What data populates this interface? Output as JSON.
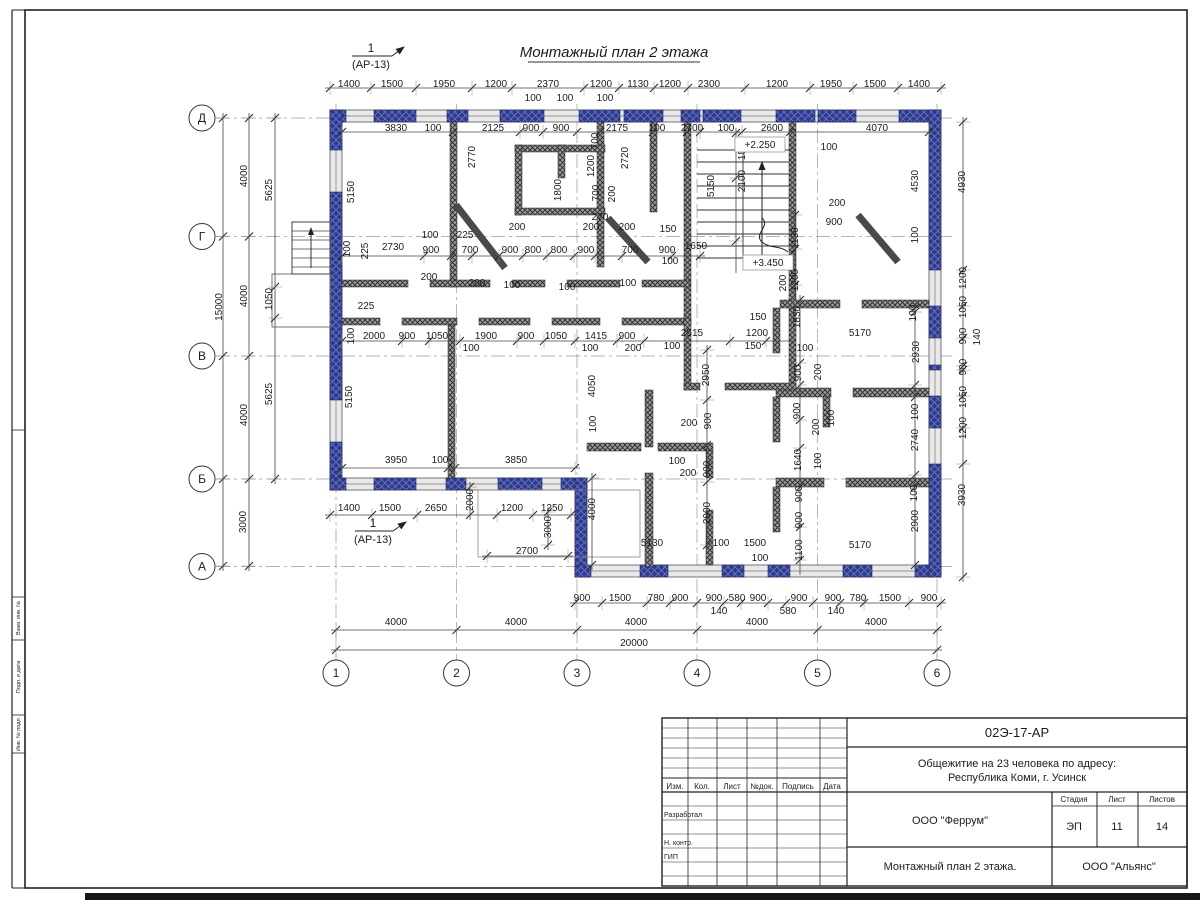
{
  "plan": {
    "title": "Монтажный план 2 этажа",
    "section_mark": {
      "number": "1",
      "sheet_ref": "(АР-13)"
    },
    "level_marks": [
      "+2.250",
      "+3.450"
    ],
    "axes": {
      "rows": [
        "Д",
        "Г",
        "В",
        "Б",
        "А"
      ],
      "cols": [
        "1",
        "2",
        "3",
        "4",
        "5",
        "6"
      ]
    },
    "overall_width": "20000",
    "overall_height": "15000"
  },
  "dim_labels": [
    [
      1400,
      349,
      84
    ],
    [
      1500,
      392,
      84
    ],
    [
      1950,
      444,
      84
    ],
    [
      1200,
      496,
      84
    ],
    [
      2370,
      548,
      84
    ],
    [
      1200,
      601,
      84
    ],
    [
      1130,
      638,
      84
    ],
    [
      1200,
      670,
      84
    ],
    [
      2300,
      709,
      84
    ],
    [
      1200,
      777,
      84
    ],
    [
      1950,
      831,
      84
    ],
    [
      1500,
      875,
      84
    ],
    [
      1400,
      919,
      84
    ],
    [
      100,
      533,
      98
    ],
    [
      100,
      565,
      98
    ],
    [
      100,
      605,
      98
    ],
    [
      3830,
      396,
      128
    ],
    [
      100,
      433,
      128
    ],
    [
      2125,
      493,
      128
    ],
    [
      900,
      531,
      128
    ],
    [
      900,
      561,
      128
    ],
    [
      2175,
      617,
      128
    ],
    [
      100,
      657,
      128
    ],
    [
      2700,
      692,
      128
    ],
    [
      100,
      726,
      128
    ],
    [
      2600,
      772,
      128
    ],
    [
      4070,
      877,
      128
    ],
    [
      100,
      829,
      147
    ],
    [
      5150,
      351,
      192,
      1
    ],
    [
      2770,
      472,
      157,
      1
    ],
    [
      1800,
      558,
      190,
      1
    ],
    [
      700,
      595,
      141,
      1
    ],
    [
      1200,
      591,
      166,
      1
    ],
    [
      700,
      596,
      193,
      1
    ],
    [
      200,
      612,
      194,
      1
    ],
    [
      270,
      600,
      217
    ],
    [
      2720,
      625,
      158,
      1
    ],
    [
      5150,
      711,
      186,
      1
    ],
    [
      1500,
      742,
      149,
      1
    ],
    [
      2100,
      742,
      181,
      1
    ],
    [
      4530,
      915,
      181,
      1
    ],
    [
      100,
      915,
      235,
      1
    ],
    [
      200,
      837,
      203
    ],
    [
      900,
      834,
      222
    ],
    [
      1130,
      795,
      238,
      1
    ],
    [
      1200,
      795,
      280,
      1
    ],
    [
      200,
      783,
      283,
      1
    ],
    [
      1650,
      696,
      246
    ],
    [
      2730,
      393,
      247
    ],
    [
      900,
      431,
      250
    ],
    [
      700,
      470,
      250
    ],
    [
      900,
      510,
      250
    ],
    [
      800,
      533,
      250
    ],
    [
      800,
      559,
      250
    ],
    [
      900,
      586,
      250
    ],
    [
      700,
      630,
      250
    ],
    [
      900,
      667,
      250
    ],
    [
      100,
      430,
      235
    ],
    [
      225,
      465,
      235
    ],
    [
      200,
      517,
      227
    ],
    [
      200,
      591,
      227
    ],
    [
      200,
      627,
      227
    ],
    [
      150,
      668,
      229
    ],
    [
      100,
      670,
      261
    ],
    [
      200,
      429,
      277
    ],
    [
      200,
      477,
      283
    ],
    [
      100,
      512,
      285
    ],
    [
      100,
      567,
      287
    ],
    [
      100,
      628,
      283
    ],
    [
      100,
      347,
      249,
      1
    ],
    [
      225,
      365,
      251,
      1
    ],
    [
      100,
      351,
      336,
      1
    ],
    [
      225,
      366,
      306
    ],
    [
      1050,
      269,
      299,
      1
    ],
    [
      5625,
      269,
      190,
      1
    ],
    [
      5625,
      269,
      394,
      1
    ],
    [
      4000,
      244,
      176,
      1
    ],
    [
      4000,
      244,
      296,
      1
    ],
    [
      4000,
      244,
      415,
      1
    ],
    [
      3000,
      243,
      522,
      1
    ],
    [
      15000,
      219,
      307,
      1
    ],
    [
      2000,
      374,
      336
    ],
    [
      900,
      407,
      336
    ],
    [
      1050,
      437,
      336
    ],
    [
      1900,
      486,
      336
    ],
    [
      900,
      526,
      336
    ],
    [
      1050,
      556,
      336
    ],
    [
      1415,
      596,
      336
    ],
    [
      900,
      627,
      336
    ],
    [
      100,
      471,
      348
    ],
    [
      100,
      590,
      348
    ],
    [
      200,
      633,
      348
    ],
    [
      5150,
      349,
      397,
      1
    ],
    [
      4050,
      592,
      386,
      1
    ],
    [
      100,
      593,
      424,
      1
    ],
    [
      2515,
      692,
      333
    ],
    [
      1200,
      757,
      333
    ],
    [
      150,
      758,
      317
    ],
    [
      150,
      753,
      346
    ],
    [
      100,
      672,
      346
    ],
    [
      2950,
      706,
      375,
      1
    ],
    [
      1830,
      797,
      317,
      1
    ],
    [
      100,
      805,
      348
    ],
    [
      5170,
      860,
      333
    ],
    [
      100,
      913,
      313,
      1
    ],
    [
      2930,
      916,
      352,
      1
    ],
    [
      900,
      798,
      373,
      1
    ],
    [
      200,
      818,
      372,
      1
    ],
    [
      900,
      797,
      411,
      1
    ],
    [
      200,
      816,
      427,
      1
    ],
    [
      100,
      831,
      418,
      1
    ],
    [
      1640,
      798,
      460,
      1
    ],
    [
      100,
      818,
      461,
      1
    ],
    [
      900,
      799,
      494,
      1
    ],
    [
      900,
      799,
      520,
      1
    ],
    [
      1100,
      799,
      550,
      1
    ],
    [
      100,
      915,
      412,
      1
    ],
    [
      2740,
      915,
      440,
      1
    ],
    [
      100,
      914,
      493,
      1
    ],
    [
      2900,
      915,
      521,
      1
    ],
    [
      5170,
      860,
      545
    ],
    [
      200,
      689,
      423
    ],
    [
      900,
      708,
      421,
      1
    ],
    [
      100,
      677,
      461
    ],
    [
      200,
      688,
      473
    ],
    [
      900,
      707,
      469,
      1
    ],
    [
      2900,
      707,
      513,
      1
    ],
    [
      5130,
      652,
      543
    ],
    [
      100,
      721,
      543
    ],
    [
      1500,
      755,
      543
    ],
    [
      100,
      760,
      558
    ],
    [
      3950,
      396,
      460
    ],
    [
      100,
      440,
      460
    ],
    [
      3850,
      516,
      460
    ],
    [
      1400,
      349,
      508
    ],
    [
      1500,
      390,
      508
    ],
    [
      2650,
      436,
      508
    ],
    [
      1200,
      512,
      508
    ],
    [
      1250,
      552,
      508
    ],
    [
      2000,
      470,
      500,
      1
    ],
    [
      3000,
      548,
      527,
      1
    ],
    [
      4000,
      592,
      509,
      1
    ],
    [
      2700,
      527,
      551
    ],
    [
      900,
      582,
      598
    ],
    [
      1500,
      620,
      598
    ],
    [
      780,
      656,
      598
    ],
    [
      900,
      680,
      598
    ],
    [
      900,
      714,
      598
    ],
    [
      580,
      737,
      598
    ],
    [
      900,
      758,
      598
    ],
    [
      900,
      799,
      598
    ],
    [
      900,
      833,
      598
    ],
    [
      780,
      858,
      598
    ],
    [
      1500,
      890,
      598
    ],
    [
      900,
      929,
      598
    ],
    [
      140,
      719,
      611
    ],
    [
      580,
      788,
      611
    ],
    [
      140,
      836,
      611
    ],
    [
      4000,
      396,
      622
    ],
    [
      4000,
      516,
      622
    ],
    [
      4000,
      636,
      622
    ],
    [
      4000,
      757,
      622
    ],
    [
      4000,
      876,
      622
    ],
    [
      20000,
      634,
      643
    ],
    [
      4930,
      962,
      182,
      1
    ],
    [
      1200,
      963,
      278,
      1
    ],
    [
      1050,
      963,
      307,
      1
    ],
    [
      900,
      963,
      336,
      1
    ],
    [
      140,
      977,
      337,
      1
    ],
    [
      900,
      963,
      367,
      1
    ],
    [
      1050,
      963,
      397,
      1
    ],
    [
      1200,
      963,
      428,
      1
    ],
    [
      3930,
      962,
      495,
      1
    ]
  ],
  "title_block": {
    "doc_number": "02Э-17-АР",
    "project_line1": "Общежитие на 23 человека по адресу:",
    "project_line2": "Республика Коми, г. Усинск",
    "col_izm": "Изм.",
    "col_kol": "Кол.",
    "col_list": "Лист",
    "col_doc": "№док.",
    "col_podpis": "Подпись",
    "col_data": "Дата",
    "row_razrabotal": "Разработал",
    "row_nkontr": "Н. контр.",
    "row_gip": "ГИП",
    "designer": "ООО \"Феррум\"",
    "stage_label": "Стадия",
    "sheet_label": "Лист",
    "sheets_label": "Листов",
    "stage": "ЭП",
    "sheet_no": "11",
    "sheets_total": "14",
    "sheet_title": "Монтажный план 2 этажа.",
    "contractor": "ООО \"Альянс\""
  },
  "frame": {
    "side_labels": [
      "Взам. инв. №",
      "Подп. и дата",
      "Инв. № подл."
    ]
  },
  "colors": {
    "wall_fill": "#2e3a8c",
    "wall_hatch": "#6a77c4",
    "inner_wall": "#8f8f8f",
    "line": "#333333"
  }
}
